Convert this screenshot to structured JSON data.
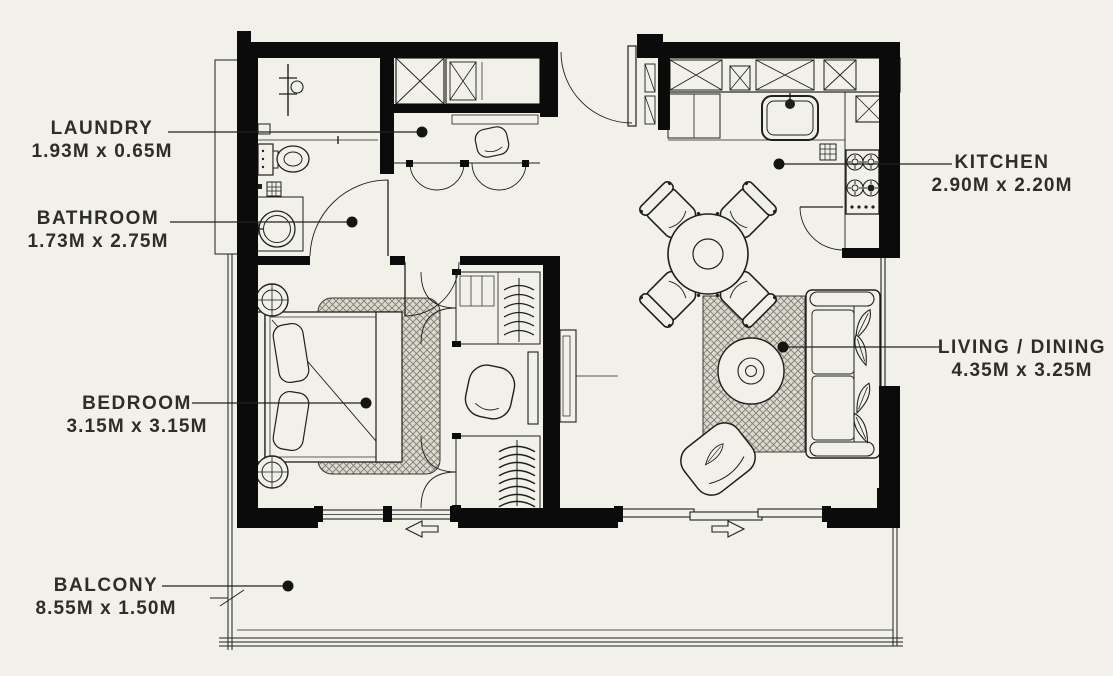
{
  "figure_type": "apartment floor plan",
  "colors": {
    "background": "#f2f1e9",
    "wall": "#0b0b0b",
    "line": "#1f1f1d",
    "label_text": "#2e2d29",
    "rug_base": "#e3e1d6",
    "rug_hatch": "#7f7d72"
  },
  "labels": {
    "laundry": {
      "name": "LAUNDRY",
      "size": "1.93M x 0.65M"
    },
    "bathroom": {
      "name": "BATHROOM",
      "size": "1.73M x 2.75M"
    },
    "bedroom": {
      "name": "BEDROOM",
      "size": "3.15M x 3.15M"
    },
    "balcony": {
      "name": "BALCONY",
      "size": "8.55M x 1.50M"
    },
    "kitchen": {
      "name": "KITCHEN",
      "size": "2.90M x 2.20M"
    },
    "living_dining": {
      "name": "LIVING / DINING",
      "size": "4.35M x 3.25M"
    }
  }
}
